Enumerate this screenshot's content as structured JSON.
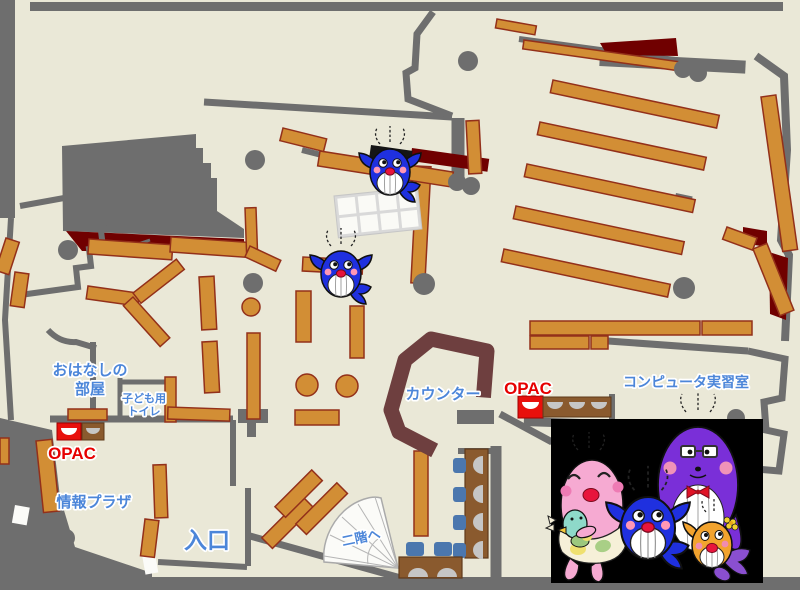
{
  "labels": {
    "storytelling_room": {
      "line1": "おはなしの",
      "line2": "部屋"
    },
    "kids_toilet": {
      "line1": "子ども用",
      "line2": "トイレ"
    },
    "opac_left": "OPAC",
    "opac_right": "OPAC",
    "info_plaza": "情報プラザ",
    "entrance": "入口",
    "counter": "カウンター",
    "computer_room": "コンピュータ実習室",
    "to_second_floor": "二階へ"
  },
  "colors": {
    "floor": "#EAE8D7",
    "wall": "#6E6E6E",
    "shelf": "#D28E35",
    "shelf_border": "#93301A",
    "dark_red_area": "#700000",
    "counter": "#6E3F3F",
    "label_blue": "#4C86D9",
    "label_red": "#E60000",
    "chair_blue": "#4B77AE",
    "desk_brown": "#8A5A2E",
    "photo_panel": "#000000",
    "whale_blue": "#1F30DF",
    "whale_purple": "#7A2FD8",
    "whale_pink": "#F6AAD2",
    "whale_orange": "#F2A32E"
  },
  "icons": {
    "whale_mascot": "blue-whale-character",
    "whale_family": "whale-family-photo",
    "stairs": "fan-shaped-staircase",
    "opac_terminal": "terminal-with-screen"
  }
}
